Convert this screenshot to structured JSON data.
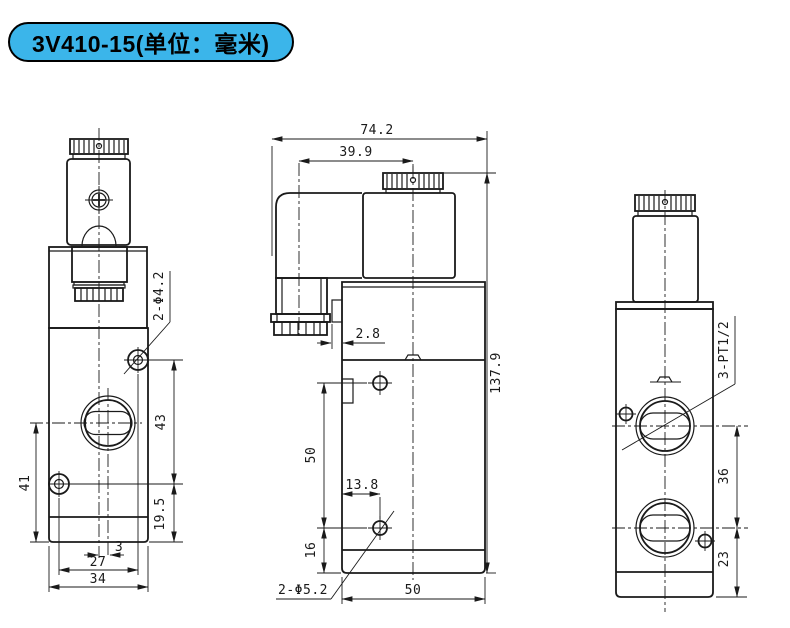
{
  "title_badge": {
    "label": "3V410-15(单位：毫米)",
    "background_color": "#3bb5ea",
    "border_color": "#000000"
  },
  "drawing": {
    "line_color": "#1a1a1a",
    "dims": {
      "front_hole_callout": "2-Φ4.2",
      "front_port_center_height": "41",
      "front_hole_vertical_spacing": "43",
      "front_hole_bottom_offset": "19.5",
      "front_port_center_offset": "3",
      "front_hole_horizontal_spacing": "27",
      "front_body_width": "34",
      "side_overall_width": "74.2",
      "side_coil_center_offset": "39.9",
      "side_tab_width": "2.8",
      "side_overall_height": "137.9",
      "side_hole_vertical_spacing": "50",
      "side_hole_horizontal_inset": "13.8",
      "side_hole_bottom_offset": "16",
      "side_hole_callout": "2-Φ5.2",
      "side_body_width": "50",
      "rear_port_callout": "3-PT1/2",
      "rear_port_vertical_spacing": "36",
      "rear_port_bottom_offset": "23"
    }
  }
}
